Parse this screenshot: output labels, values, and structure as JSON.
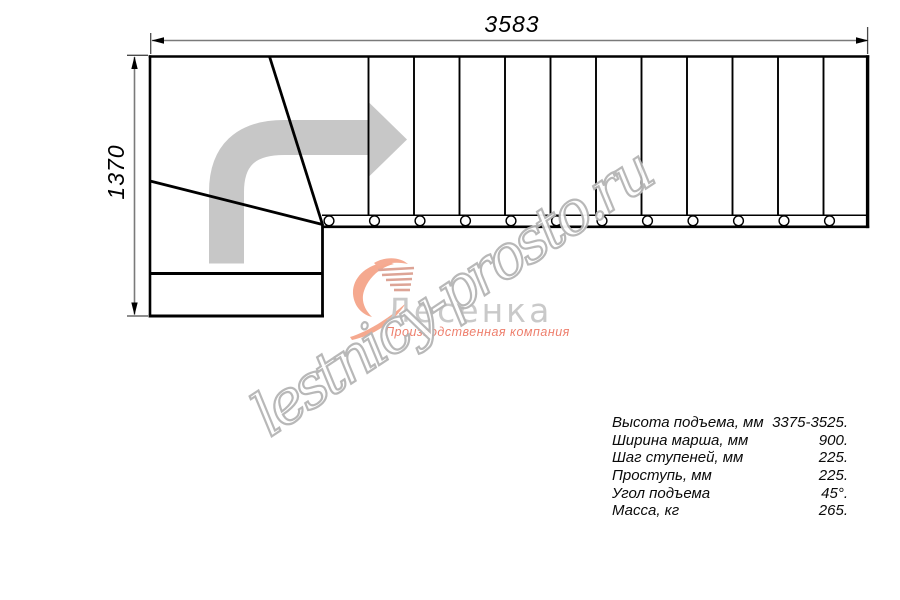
{
  "drawing": {
    "type": "staircase-top-view-plan",
    "dim_width_label": "3583",
    "dim_height_label": "1370",
    "tread_count_straight": 12,
    "direction_arrow": "up-then-right"
  },
  "watermark": {
    "text": "lestnicy-prosto.ru"
  },
  "logo": {
    "brand": "Лесенка",
    "tagline": "Производственная компания"
  },
  "specs": {
    "rows": [
      {
        "label": "Высота подъема, мм",
        "value": "3375-3525."
      },
      {
        "label": "Ширина марша, мм",
        "value": "900."
      },
      {
        "label": "Шаг ступеней, мм",
        "value": "225."
      },
      {
        "label": "Проступь, мм",
        "value": "225."
      },
      {
        "label": "Угол подъема",
        "value": "45°."
      },
      {
        "label": "Масса, кг",
        "value": "265."
      }
    ]
  },
  "colors": {
    "object_line": "#000000",
    "dimension_line": "#7a7a7a",
    "direction_arrow_gray": "#c7c7c7",
    "logo_swoosh_salmon": "#f5a98f",
    "logo_text_gray": "#c9c9c9",
    "logo_tagline_salmon": "#ee7f6d",
    "watermark_outline_gray": "#b5b5b5"
  }
}
